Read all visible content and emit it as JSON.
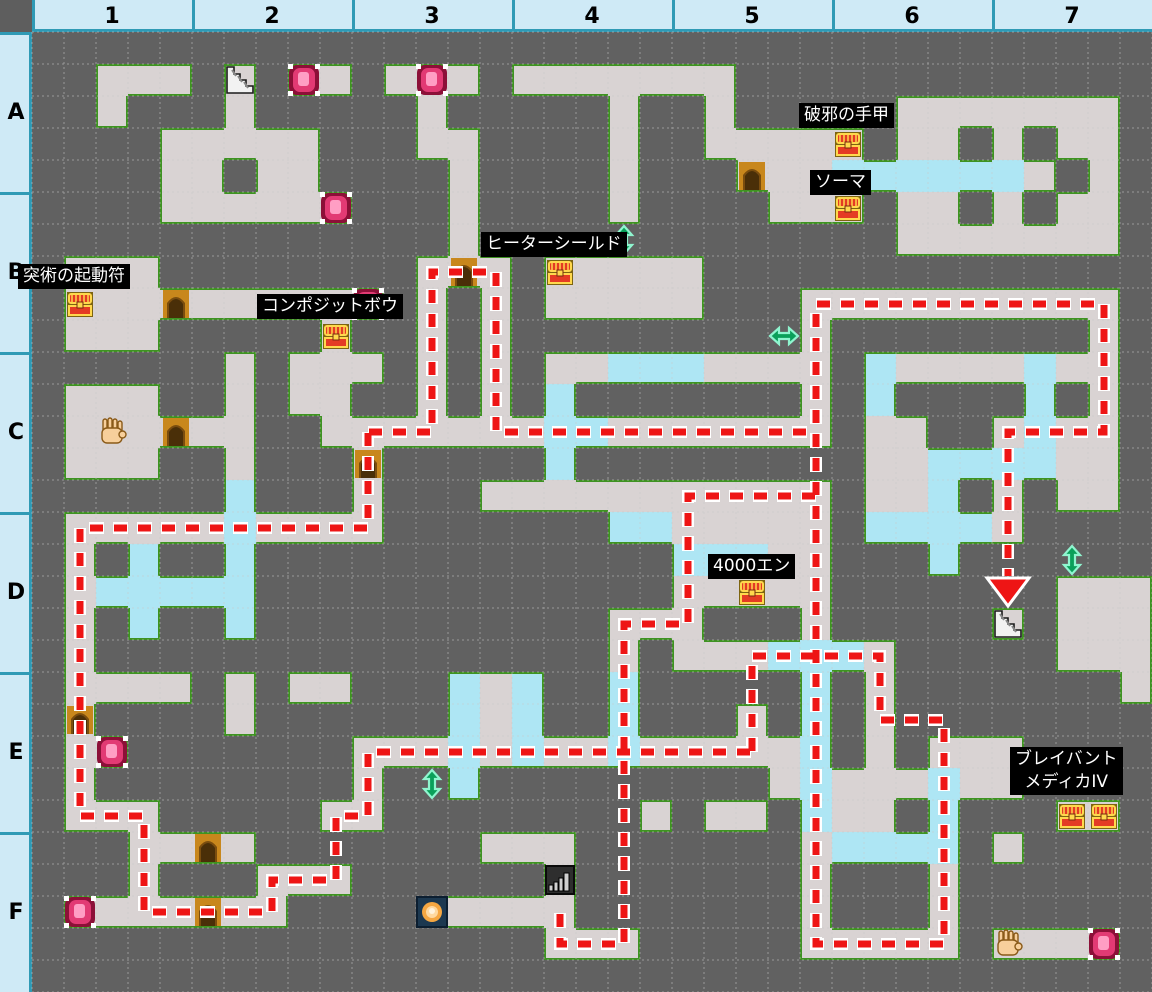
{
  "floor_map": {
    "header": {
      "columns": [
        "1",
        "2",
        "3",
        "4",
        "5",
        "6",
        "7"
      ],
      "rows": [
        "A",
        "B",
        "C",
        "D",
        "E",
        "F"
      ]
    },
    "tile_size": 32,
    "grid_cols": 35,
    "grid_rows": 30,
    "legend": {
      "#": "wall",
      ".": "floor",
      "~": "water"
    },
    "tiles": [
      "###################################",
      "##...#.#..#...#.......#############",
      "##.###.#####.#####.##.#####.......#",
      "####.....###..####.##.....#..#.#..#",
      "####..#..####.####.###...~~~~~~.#.#",
      "####......###.####.####...#..#.#..#",
      "#############.#############.......#",
      "#...########...#.....##############",
      "#..........#.#.#.....###..........#",
      "#...#####.##.#.#########.########.#",
      "######.#...#.#.#..~~~....#~....~..#",
      "#...##.#..##.#.#~#######.#~####~#.#",
      "#......##.......~~.......#..##.~..#",
      "#...##.###.#####~#########..~~~~..#",
      "######~###.###...........#..~#.#..#",
      "#.....~....#######~~.....#~~~~.####",
      "#.#~##~#############~~~..###~######",
      "#.~~~~~#############.....#######...",
      "#.#~##~###########...###.#####.#...",
      "#.################.#...~~~.#####...",
      "#....#.#..###~.~##~#####~#.#######.",
      "#.####.######~.~##~###.#~#.########",
      "#..#######...~.~..~.....~#.#...####",
      "#.########.##~#########.~...~..####",
      "#...#####..########.#..#~..#~###..#",
      "###....#######...#######.~~~~#.####",
      "###.###...######.#######.###.######",
      "#.......####.....#######.###.######",
      "################...#####.....#....#",
      "###################################"
    ]
  },
  "items": {
    "chests": [
      {
        "col": 25,
        "row": 3,
        "label": "破邪の手甲"
      },
      {
        "col": 25,
        "row": 5,
        "label": "ソーマ"
      },
      {
        "col": 16,
        "row": 7,
        "label": "ヒーターシールド"
      },
      {
        "col": 1,
        "row": 8,
        "label": "突術の起動符"
      },
      {
        "col": 9,
        "row": 9,
        "label": "コンポジットボウ"
      },
      {
        "col": 22,
        "row": 17,
        "label": "4000エン"
      },
      {
        "col": 32,
        "row": 24,
        "label": "ブレイバント メディカIV"
      },
      {
        "col": 33,
        "row": 24,
        "label": "ブレイバント メディカIV"
      }
    ],
    "doors": [
      {
        "col": 22,
        "row": 4
      },
      {
        "col": 4,
        "row": 8
      },
      {
        "col": 13,
        "row": 7
      },
      {
        "col": 4,
        "row": 12
      },
      {
        "col": 10,
        "row": 13
      },
      {
        "col": 1,
        "row": 21
      },
      {
        "col": 5,
        "row": 25
      },
      {
        "col": 5,
        "row": 27
      }
    ],
    "foe_orbs": [
      {
        "col": 8,
        "row": 1
      },
      {
        "col": 12,
        "row": 1
      },
      {
        "col": 9,
        "row": 5
      },
      {
        "col": 10,
        "row": 8
      },
      {
        "col": 2,
        "row": 22
      },
      {
        "col": 1,
        "row": 27
      },
      {
        "col": 33,
        "row": 28
      }
    ],
    "gather_hands": [
      {
        "col": 2,
        "row": 12
      },
      {
        "col": 30,
        "row": 28
      }
    ],
    "mine_points": [
      {
        "col": 12,
        "row": 27
      }
    ],
    "stairs": [
      {
        "col": 6,
        "row": 1,
        "kind": "up"
      },
      {
        "col": 30,
        "row": 18,
        "kind": "down-with-red-arrow"
      },
      {
        "col": 16,
        "row": 26,
        "kind": "down-dark"
      }
    ],
    "shortcut_arrows": [
      {
        "col": 18,
        "row": 6,
        "dir": "v"
      },
      {
        "col": 23,
        "row": 9,
        "dir": "h"
      },
      {
        "col": 12,
        "row": 23,
        "dir": "v"
      },
      {
        "col": 32,
        "row": 16,
        "dir": "v"
      }
    ]
  },
  "labels": [
    {
      "text": "突術の起動符",
      "x": 18,
      "y": 264
    },
    {
      "text": "コンポジットボウ",
      "x": 257,
      "y": 294
    },
    {
      "text": "ヒーターシールド",
      "x": 481,
      "y": 232
    },
    {
      "text": "破邪の手甲",
      "x": 799,
      "y": 103
    },
    {
      "text": "ソーマ",
      "x": 810,
      "y": 170
    },
    {
      "text": "4000エン",
      "x": 708,
      "y": 554
    },
    {
      "text": "ブレイバント\nメディカIV",
      "x": 1010,
      "y": 747
    }
  ],
  "route": {
    "polylines": [
      [
        [
          10,
          12
        ],
        [
          12,
          12
        ],
        [
          12,
          7
        ],
        [
          14,
          7
        ],
        [
          14,
          12
        ],
        [
          24,
          12
        ]
      ],
      [
        [
          10,
          12
        ],
        [
          10,
          15
        ],
        [
          1,
          15
        ],
        [
          1,
          24
        ],
        [
          3,
          24
        ],
        [
          3,
          27
        ],
        [
          7,
          27
        ],
        [
          7,
          26
        ],
        [
          9,
          26
        ],
        [
          9,
          24
        ],
        [
          10,
          24
        ],
        [
          10,
          22
        ],
        [
          22,
          22
        ]
      ],
      [
        [
          22,
          22
        ],
        [
          22,
          19
        ],
        [
          26,
          19
        ],
        [
          26,
          21
        ],
        [
          28,
          21
        ],
        [
          28,
          28
        ],
        [
          24,
          28
        ],
        [
          24,
          8
        ],
        [
          33,
          8
        ],
        [
          33,
          12
        ],
        [
          30,
          12
        ],
        [
          30,
          16.5
        ]
      ],
      [
        [
          24,
          14
        ],
        [
          20,
          14
        ],
        [
          20,
          18
        ],
        [
          18,
          18
        ],
        [
          18,
          28
        ],
        [
          16,
          28
        ],
        [
          16,
          26.9
        ]
      ]
    ],
    "arrowhead": {
      "tip_x": 1008,
      "tip_y": 606,
      "base_y": 578,
      "half_width": 21
    }
  },
  "colors": {
    "wall": "#616161",
    "floor": "#d9d3d3",
    "water": "#aee6f4",
    "floor_border": "#3f9222",
    "header_bg": "#cfeaf6",
    "header_border": "#2f9ab5",
    "header_text": "#000000",
    "route_red": "#ee1515",
    "route_outline": "#ffffff",
    "grid_dots": "#c9c9c9",
    "label_bg": "#000000",
    "label_text": "#ffffff",
    "door_frame": "#c8871c",
    "door_inner": "#4a2f08",
    "chest_red": "#e43b24",
    "chest_gold": "#ffd84d",
    "chest_bg": "#7d6410",
    "orb_dark": "#8c1038",
    "orb_mid": "#e23a74",
    "orb_light": "#ff9ec4",
    "mine_bg": "#1c3850",
    "mine_glow": "#f5a742",
    "arrow_green": "#0aa05a",
    "arrow_green_edge": "#8ff5cf",
    "hand_skin": "#f7cf9b"
  }
}
